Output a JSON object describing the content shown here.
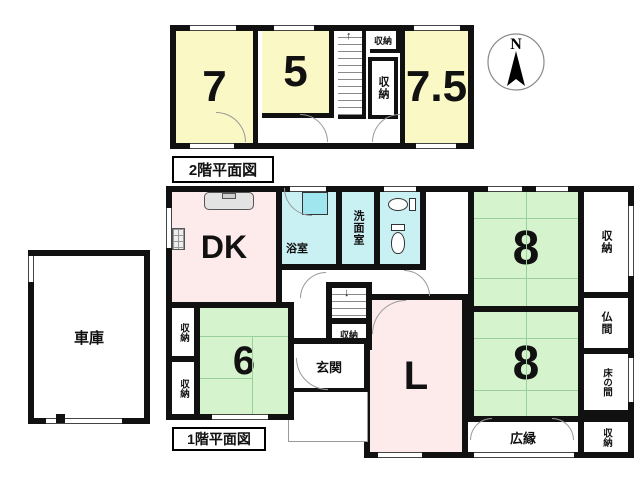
{
  "compass": {
    "north": "N"
  },
  "floor2": {
    "caption": "2階平面図",
    "rooms": {
      "room7": "7",
      "room5": "5",
      "room75": "7.5",
      "closet_top": "収納",
      "closet_side": "収納"
    }
  },
  "floor1": {
    "caption": "1階平面図",
    "rooms": {
      "dk": "DK",
      "bath": "浴室",
      "washroom": "洗面室",
      "living": "L",
      "genkan": "玄関",
      "room6": "6",
      "room8_top": "8",
      "room8_bottom": "8",
      "closet_right": "収納",
      "butsuma": "仏間",
      "tokonoma": "床の間",
      "hiroen": "広縁",
      "closet_se": "収納",
      "closet_stair": "収納",
      "closet_w1": "収納",
      "closet_w2": "収納"
    }
  },
  "garage": {
    "label": "車庫"
  },
  "colors": {
    "wall": "#111111",
    "tatami_green": "#d5f3cd",
    "tatami_line": "#9bcf9b",
    "western_yellow": "#faf8c4",
    "wet_cyan": "#c9f0f2",
    "ldk_pink": "#fdeaea"
  }
}
